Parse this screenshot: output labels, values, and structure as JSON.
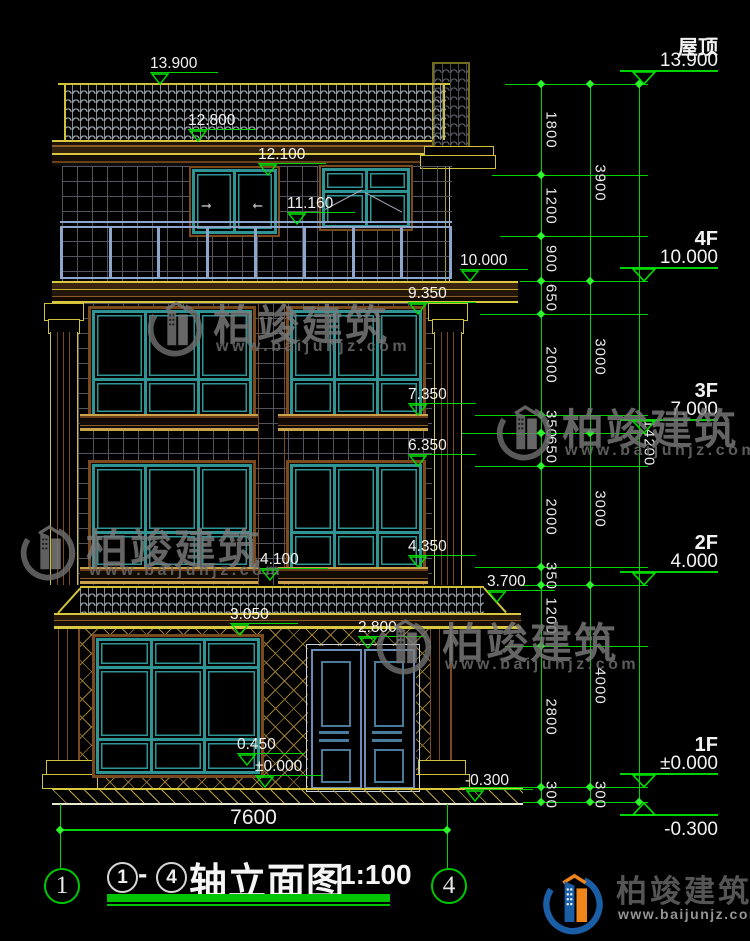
{
  "colors": {
    "background": "#000000",
    "dimension_green": "#00d400",
    "outline_yellow": "#cfc23a",
    "trim_brown": "#7a4a1e",
    "window_teal": "#2f9494",
    "railing_blue": "#8ca6cc",
    "door_blue": "#5f86b0",
    "text_white": "#f2f2f2"
  },
  "floor_levels": [
    {
      "name": "屋顶",
      "value": "13.900",
      "y": 84
    },
    {
      "name": "4F",
      "value": "10.000",
      "y": 281
    },
    {
      "name": "3F",
      "value": "7.000",
      "y": 433
    },
    {
      "name": "2F",
      "value": "4.000",
      "y": 585
    },
    {
      "name": "1F",
      "value": "±0.000",
      "y": 787
    },
    {
      "name": "",
      "value": "-0.300",
      "y": 802,
      "mirror": true
    }
  ],
  "spot_elevations": [
    {
      "t": "13.900",
      "x": 160,
      "y": 84
    },
    {
      "t": "12.800",
      "x": 198,
      "y": 141
    },
    {
      "t": "12.100",
      "x": 268,
      "y": 175
    },
    {
      "t": "11.160",
      "x": 297,
      "y": 224
    },
    {
      "t": "10.000",
      "x": 470,
      "y": 281
    },
    {
      "t": "9.350",
      "x": 418,
      "y": 314
    },
    {
      "t": "7.350",
      "x": 418,
      "y": 415
    },
    {
      "t": "6.350",
      "x": 418,
      "y": 466
    },
    {
      "t": "4.350",
      "x": 418,
      "y": 567
    },
    {
      "t": "4.100",
      "x": 270,
      "y": 580
    },
    {
      "t": "3.700",
      "x": 497,
      "y": 602
    },
    {
      "t": "3.050",
      "x": 240,
      "y": 635
    },
    {
      "t": "2.800",
      "x": 368,
      "y": 648
    },
    {
      "t": "0.450",
      "x": 247,
      "y": 765
    },
    {
      "t": "±0.000",
      "x": 265,
      "y": 787
    },
    {
      "t": "-0.300",
      "x": 475,
      "y": 801
    }
  ],
  "dimension_chains": [
    {
      "x": 541,
      "segs": [
        [
          84,
          175,
          "1800"
        ],
        [
          175,
          236,
          "1200"
        ],
        [
          236,
          281,
          "900"
        ],
        [
          281,
          314,
          "650"
        ],
        [
          314,
          415,
          "2000"
        ],
        [
          415,
          433,
          "350"
        ],
        [
          433,
          466,
          "650"
        ],
        [
          466,
          567,
          "2000"
        ],
        [
          567,
          585,
          "350"
        ],
        [
          585,
          646,
          "1200"
        ],
        [
          646,
          787,
          "2800"
        ],
        [
          787,
          802,
          "300"
        ]
      ]
    },
    {
      "x": 590,
      "segs": [
        [
          84,
          281,
          "3900"
        ],
        [
          281,
          433,
          "3000"
        ],
        [
          433,
          585,
          "3000"
        ],
        [
          585,
          787,
          "4000"
        ],
        [
          787,
          802,
          "300"
        ]
      ]
    },
    {
      "x": 639,
      "segs": [
        [
          84,
          802,
          "14200"
        ]
      ]
    }
  ],
  "extension_lines": [
    {
      "y": 84,
      "x1": 505,
      "x2": 648
    },
    {
      "y": 175,
      "x1": 492,
      "x2": 648
    },
    {
      "y": 236,
      "x1": 500,
      "x2": 648
    },
    {
      "y": 281,
      "x1": 520,
      "x2": 648
    },
    {
      "y": 314,
      "x1": 480,
      "x2": 648
    },
    {
      "y": 415,
      "x1": 475,
      "x2": 648
    },
    {
      "y": 433,
      "x1": 462,
      "x2": 648
    },
    {
      "y": 466,
      "x1": 475,
      "x2": 648
    },
    {
      "y": 567,
      "x1": 475,
      "x2": 648
    },
    {
      "y": 585,
      "x1": 522,
      "x2": 648
    },
    {
      "y": 646,
      "x1": 505,
      "x2": 648
    },
    {
      "y": 787,
      "x1": 460,
      "x2": 648
    },
    {
      "y": 802,
      "x1": 523,
      "x2": 648
    }
  ],
  "overall_width_dim": {
    "label": "7600"
  },
  "axis_bubbles": {
    "left": "1",
    "right": "4"
  },
  "drawing_title": {
    "circle_from": "1",
    "dash": "-",
    "circle_to": "4",
    "name": "轴立面图",
    "scale": "1:100"
  },
  "watermark": {
    "brand": "柏竣建筑",
    "url": "www.baijunjz.com",
    "instances": [
      {
        "x": 143,
        "y": 292
      },
      {
        "x": 492,
        "y": 396
      },
      {
        "x": 16,
        "y": 516
      },
      {
        "x": 372,
        "y": 610
      }
    ]
  },
  "footer_logo": {
    "brand": "柏竣建筑",
    "url": "www.baijunjz.com"
  }
}
